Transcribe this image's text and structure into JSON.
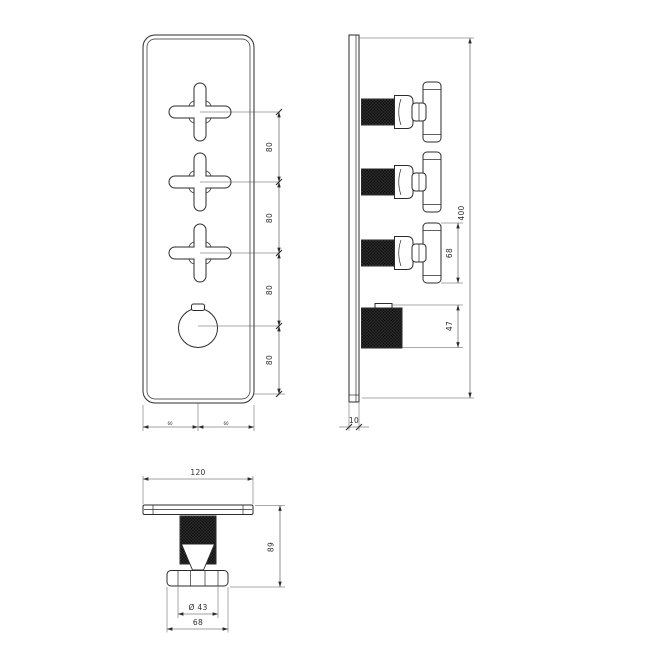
{
  "drawing": {
    "background": "#ffffff",
    "ink_color": "#2b2b2b",
    "knurl_color": "#141414"
  },
  "front_view": {
    "spacing_labels": [
      "80",
      "80",
      "80",
      "80"
    ],
    "bottom_half_labels": [
      "60",
      "60"
    ]
  },
  "side_view": {
    "overall_height": "400",
    "handle_profile_height": "68",
    "knob_profile_height": "47",
    "plate_thickness": "10"
  },
  "bottom_view": {
    "plate_width": "120",
    "overall_depth": "89",
    "knurl_diameter": "Ø 43",
    "handle_span": "68"
  }
}
